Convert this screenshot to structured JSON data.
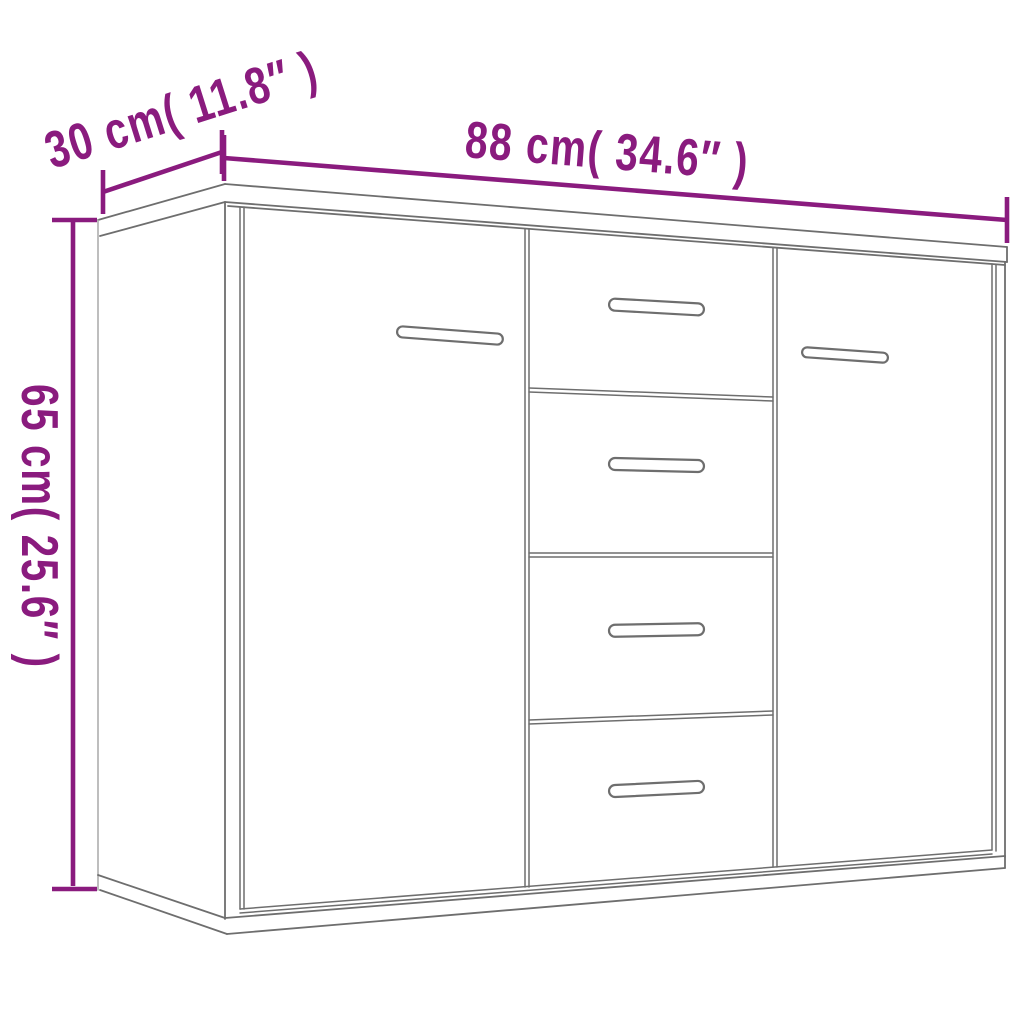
{
  "diagram": {
    "title": "furniture dimension drawing",
    "dimensions": {
      "width_label": "88 cm( 34.6″ )",
      "depth_label": "30 cm( 11.8″ )",
      "height_label": "65 cm( 25.6″ )"
    },
    "figure": {
      "object": "sideboard",
      "doors": 2,
      "drawers": 4,
      "handles": 6
    }
  },
  "colors": {
    "accent": "#8a1b7e",
    "outline": "#6e6e6e",
    "outline_light": "#a8a8a8",
    "handle_fill": "#ffffff",
    "background": "#ffffff"
  }
}
